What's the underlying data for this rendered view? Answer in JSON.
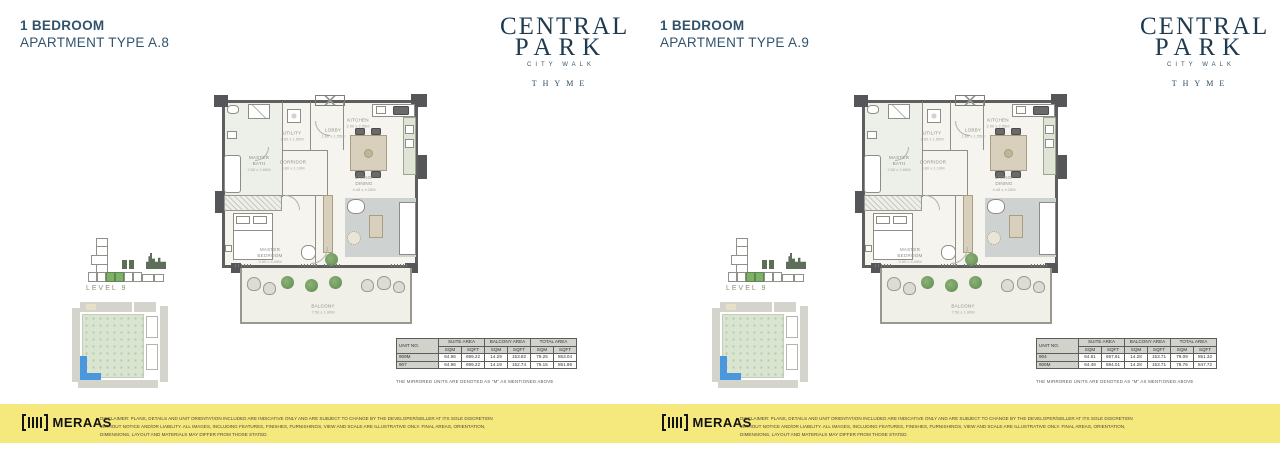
{
  "brand": {
    "name_line1": "CENTRAL",
    "name_line2": "PARK",
    "subtitle": "CITY WALK",
    "property": "THYME",
    "developer": "MERAAS"
  },
  "floorplan": {
    "rooms": {
      "master_bath": {
        "name": "MASTER BATH",
        "dims": "2.50 x 1.60M"
      },
      "utility": {
        "name": "UTILITY",
        "dims": "1.60 x 1.50M"
      },
      "lobby": {
        "name": "LOBBY",
        "dims": "1.80 x 1.55M"
      },
      "kitchen": {
        "name": "KITCHEN",
        "dims": "2.90 x 2.55M"
      },
      "corridor": {
        "name": "CORRIDOR",
        "dims": "3.80 x 1.10M"
      },
      "living_dining": {
        "name": "LIVING/ DINING",
        "dims": "4.45 x 4.20M"
      },
      "master_bedroom": {
        "name": "MASTER BEDROOM",
        "dims": "3.50 x 4.00M"
      },
      "balcony": {
        "name": "BALCONY",
        "dims": "7.50 x 1.90M"
      }
    }
  },
  "panels": [
    {
      "title_line1": "1 BEDROOM",
      "title_line2": "APARTMENT TYPE A.8",
      "level_label": "LEVEL 9",
      "table": {
        "col_unit": "UNIT NO.",
        "col_suite": "SUITE AREA",
        "col_balcony": "BALCONY AREA",
        "col_total": "TOTAL AREA",
        "sqm": "SQM",
        "sqft": "SQFT",
        "rows": [
          {
            "unit": "909M",
            "suite_sqm": "64.96",
            "suite_sqft": "699.22",
            "balcony_sqm": "14.29",
            "balcony_sqft": "153.82",
            "total_sqm": "79.25",
            "total_sqft": "853.04"
          },
          {
            "unit": "907",
            "suite_sqm": "64.96",
            "suite_sqft": "699.22",
            "balcony_sqm": "14.19",
            "balcony_sqft": "152.74",
            "total_sqm": "79.15",
            "total_sqft": "851.96"
          }
        ],
        "footnote": "THE MIRRORED UNITS ARE DENOTED AS \"M\" AS MENTIONED ABOVE"
      },
      "disclaimer": "DISCLAIMER: PLANS, DETAILS AND UNIT ORIENTATION INCLUDED ARE INDICATIVE ONLY AND ARE SUBJECT TO CHANGE BY THE DEVELOPER/SELLER AT ITS SOLE DISCRETION WITHOUT NOTICE AND/OR LIABILITY. ALL IMAGES, INCLUDING FEATURES, FINISHES, FURNISHINGS, VIEW AND SCALE ARE ILLUSTRATIVE ONLY. FINAL AREAS, ORIENTATION, DIMENSIONS, LAYOUT AND MATERIALS MAY DIFFER FROM THOSE STATED."
    },
    {
      "title_line1": "1 BEDROOM",
      "title_line2": "APARTMENT TYPE A.9",
      "level_label": "LEVEL 9",
      "table": {
        "col_unit": "UNIT NO.",
        "col_suite": "SUITE AREA",
        "col_balcony": "BALCONY AREA",
        "col_total": "TOTAL AREA",
        "sqm": "SQM",
        "sqft": "SQFT",
        "rows": [
          {
            "unit": "904",
            "suite_sqm": "64.81",
            "suite_sqft": "697.61",
            "balcony_sqm": "14.28",
            "balcony_sqft": "153.71",
            "total_sqm": "79.09",
            "total_sqft": "851.32"
          },
          {
            "unit": "906M",
            "suite_sqm": "64.48",
            "suite_sqft": "694.01",
            "balcony_sqm": "14.28",
            "balcony_sqft": "153.71",
            "total_sqm": "78.76",
            "total_sqft": "847.72"
          }
        ],
        "footnote": "THE MIRRORED UNITS ARE DENOTED AS \"M\" AS MENTIONED ABOVE"
      },
      "disclaimer": "DISCLAIMER: PLANS, DETAILS AND UNIT ORIENTATION INCLUDED ARE INDICATIVE ONLY AND ARE SUBJECT TO CHANGE BY THE DEVELOPER/SELLER AT ITS SOLE DISCRETION WITHOUT NOTICE AND/OR LIABILITY. ALL IMAGES, INCLUDING FEATURES, FINISHES, FURNISHINGS, VIEW AND SCALE ARE ILLUSTRATIVE ONLY. FINAL AREAS, ORIENTATION, DIMENSIONS, LAYOUT AND MATERIALS MAY DIFFER FROM THOSE STATED."
    }
  ],
  "colors": {
    "title_text": "#32536d",
    "logo_navy": "#1d3a50",
    "footer_yellow": "#f5e87d",
    "keyplan_highlight": "#7fb069",
    "siteplan_blue": "#4a97dd",
    "plan_wall": "#5e5e5e",
    "plant_green": "#79a468"
  }
}
